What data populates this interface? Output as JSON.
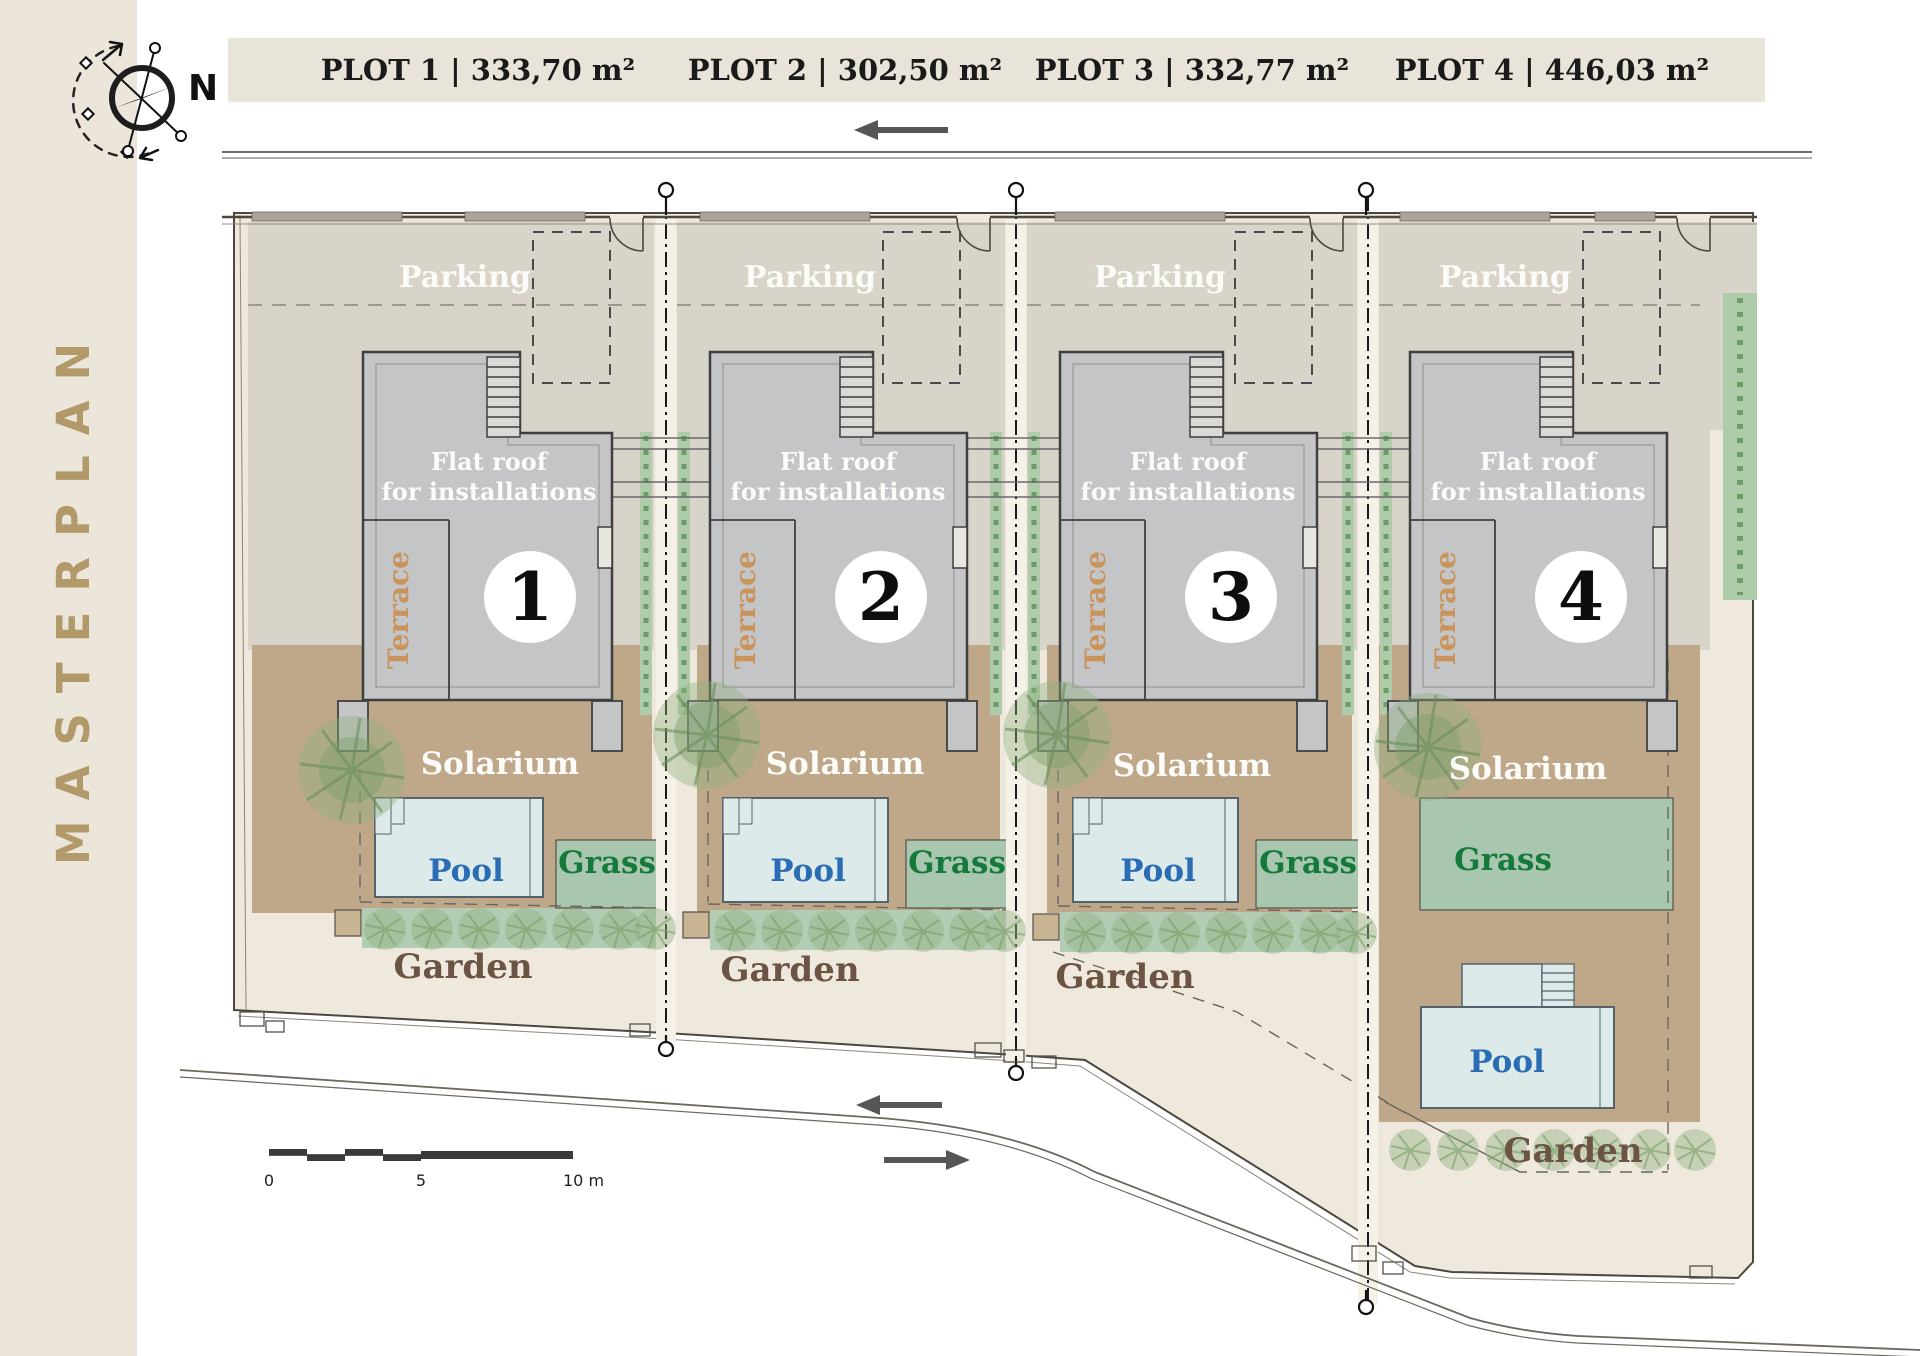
{
  "sidebar": {
    "title": "MASTERPLAN"
  },
  "compass": {
    "north_label": "N"
  },
  "header": {
    "plots": [
      {
        "label": "PLOT 1 | 333,70 m²"
      },
      {
        "label": "PLOT 2 | 302,50 m²"
      },
      {
        "label": "PLOT 3 | 332,77 m²"
      },
      {
        "label": "PLOT 4 | 446,03 m²"
      }
    ]
  },
  "plots": [
    {
      "number": "1",
      "parking": "Parking",
      "flat_roof_1": "Flat roof",
      "flat_roof_2": "for installations",
      "terrace": "Terrace",
      "solarium": "Solarium",
      "pool": "Pool",
      "grass": "Grass",
      "garden": "Garden"
    },
    {
      "number": "2",
      "parking": "Parking",
      "flat_roof_1": "Flat roof",
      "flat_roof_2": "for installations",
      "terrace": "Terrace",
      "solarium": "Solarium",
      "pool": "Pool",
      "grass": "Grass",
      "garden": "Garden"
    },
    {
      "number": "3",
      "parking": "Parking",
      "flat_roof_1": "Flat roof",
      "flat_roof_2": "for installations",
      "terrace": "Terrace",
      "solarium": "Solarium",
      "pool": "Pool",
      "grass": "Grass",
      "garden": "Garden"
    },
    {
      "number": "4",
      "parking": "Parking",
      "flat_roof_1": "Flat roof",
      "flat_roof_2": "for installations",
      "terrace": "Terrace",
      "solarium": "Solarium",
      "pool": "Pool",
      "grass": "Grass",
      "garden": "Garden"
    }
  ],
  "scale_bar": {
    "start": "0",
    "mid": "5",
    "end": "10 m"
  },
  "colors": {
    "sidebar_bg": "#ece6da",
    "masterplan_text": "#b2996a",
    "header_bg": "#e9e4da",
    "header_text": "#1a1a1a",
    "site_beige": "#efe9dd",
    "parking_gray": "#d8d4c9",
    "building_gray": "#c4c5c7",
    "building_stroke": "#3f3f3f",
    "solarium_tan": "#bfa88a",
    "pool_fill": "#dceae9",
    "pool_text": "#2a6db5",
    "grass_fill": "#a9c7ae",
    "grass_text": "#15793b",
    "garden_strip": "#b3cdb4",
    "garden_text": "#6b5443",
    "terrace_text": "#c9935a",
    "hedge_green": "#aecbaa",
    "white_label": "#fbfbf8"
  }
}
